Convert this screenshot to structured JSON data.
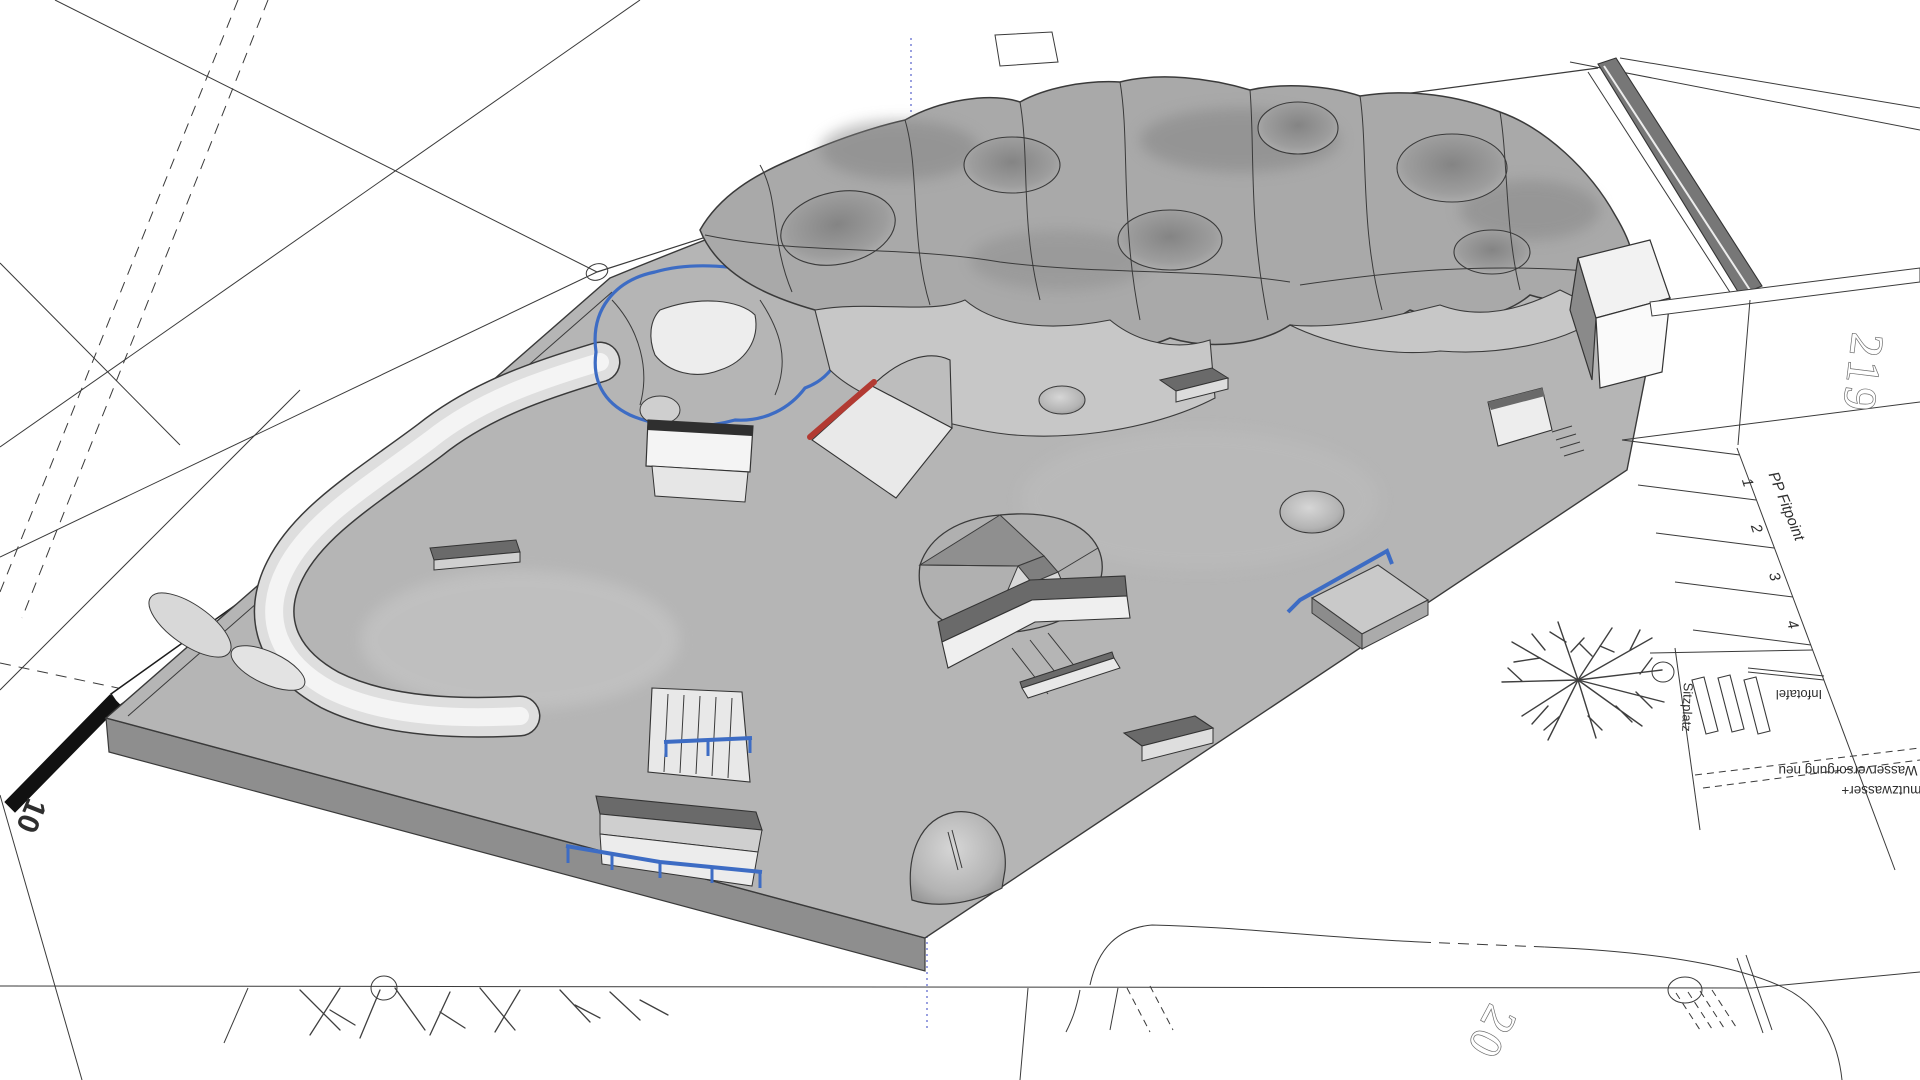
{
  "colors": {
    "background": "#ffffff",
    "line": "#3a3a3a",
    "slab": "#b5b5b5",
    "slab_side": "#8e8e8e",
    "terrain": "#a9a9a9",
    "terrain_light": "#c7c7c7",
    "element_white": "#f0f0f0",
    "ledge_dark": "#6a6a6a",
    "coping_blue": "#3d6cc4",
    "rail_red": "#b23a32",
    "wall_dark": "#777777",
    "axis_blue": "#8089d8"
  },
  "site_plan": {
    "parcel_number": "219",
    "parcel_number_partial": "20",
    "parking": {
      "label": "PP Fitpoint",
      "stalls": [
        "1",
        "2",
        "3",
        "4"
      ]
    },
    "furniture": {
      "seating_label": "Sitzplatz",
      "info_label": "Infotafel"
    },
    "utilities": {
      "line1": "Wasserversorgung neu",
      "line2": "Schmutzwasser+"
    },
    "scale_bar": {
      "mid": "5",
      "end": "10"
    }
  }
}
